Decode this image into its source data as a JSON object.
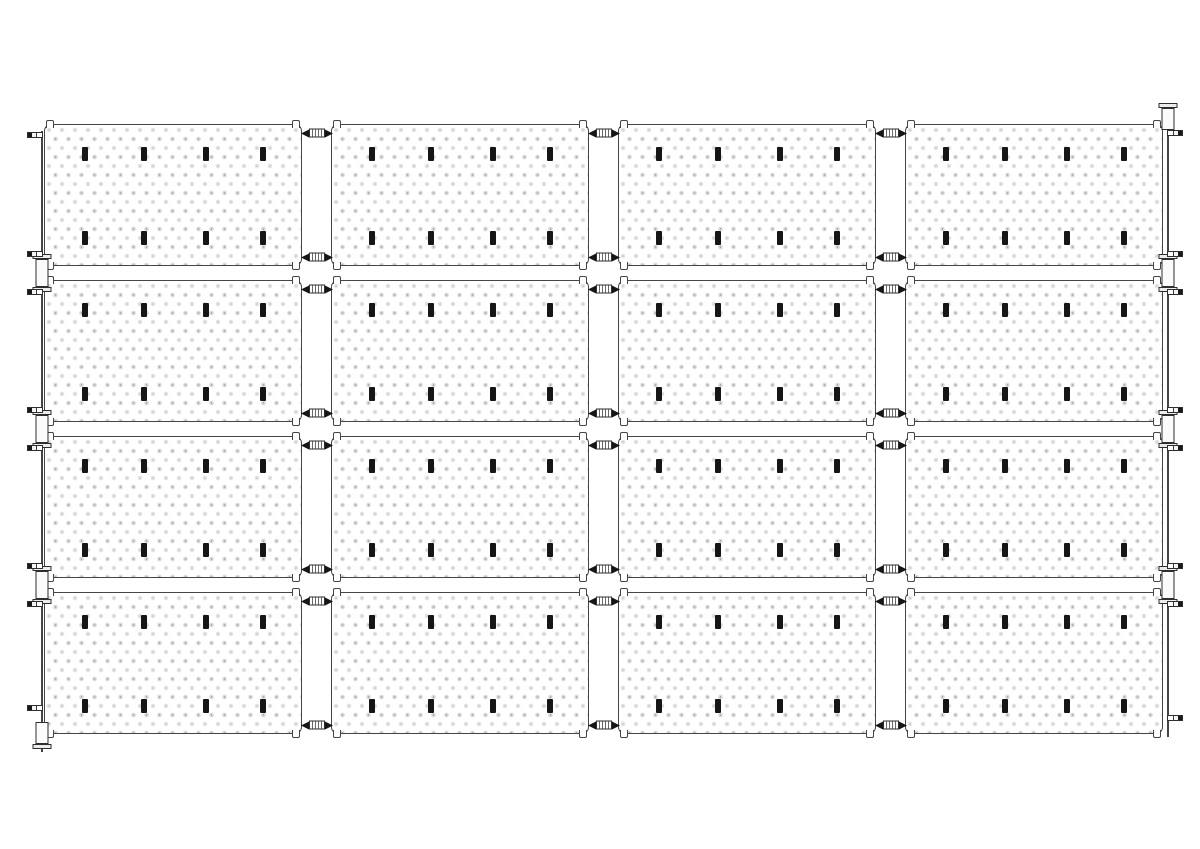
{
  "diagram": {
    "type": "technical-line-drawing",
    "subject": "perforated-panel-array-elevation",
    "canvas": {
      "width": 1200,
      "height": 849,
      "background": "#ffffff"
    },
    "colors": {
      "outline": "#454545",
      "hardware": "#2e2e2e",
      "mark": "#161616",
      "fill": "#ffffff",
      "dot": "#8c8c8c"
    },
    "grid": {
      "rows": 4,
      "cols": 4,
      "origin_x": 44,
      "origin_y": 124,
      "panel_width": 258,
      "panel_height": 142,
      "gap_x": 29,
      "gap_y": 14
    },
    "panel": {
      "corner_radius": 7,
      "corner_hooks": [
        "tl",
        "tr",
        "bl",
        "br"
      ]
    },
    "marks": {
      "width": 6,
      "height": 14,
      "row_pct": [
        21,
        81
      ],
      "col_pct": [
        15.8,
        38.5,
        63,
        85
      ]
    },
    "connectors": {
      "inset_y": 9,
      "per_gap_per_row": 2
    },
    "left_edge": {
      "rail_x": 41,
      "rail_y1": 131,
      "rail_y2": 752,
      "brackets": [
        {
          "cy": 273,
          "caps": "both"
        },
        {
          "cy": 429,
          "caps": "both"
        },
        {
          "cy": 585,
          "caps": "both"
        },
        {
          "cy": 735,
          "caps": "bottom"
        }
      ],
      "bolts": [
        135,
        254,
        292,
        410,
        448,
        566,
        604,
        708
      ]
    },
    "right_edge": {
      "rail_x": 1167,
      "rail_y1": 103,
      "rail_y2": 737,
      "brackets": [
        {
          "cy": 116,
          "caps": "top"
        },
        {
          "cy": 273,
          "caps": "both"
        },
        {
          "cy": 429,
          "caps": "both"
        },
        {
          "cy": 585,
          "caps": "both"
        }
      ],
      "bolts": [
        133,
        254,
        292,
        410,
        448,
        566,
        604,
        718
      ]
    }
  }
}
